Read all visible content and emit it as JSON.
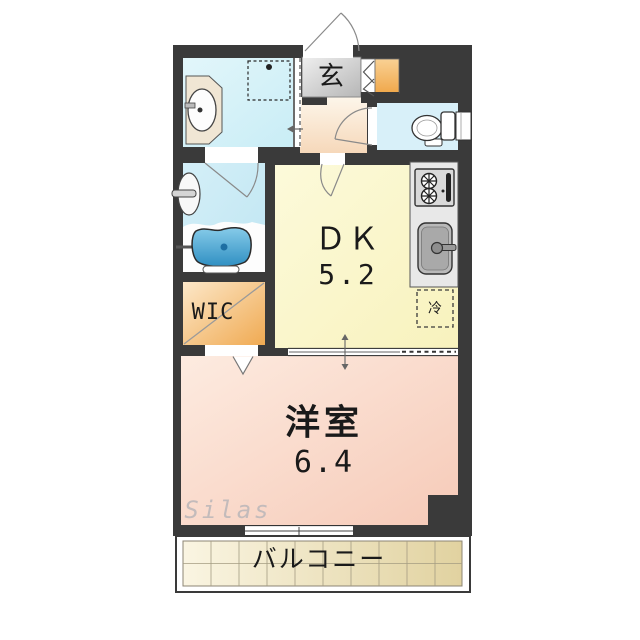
{
  "rooms": {
    "entrance": {
      "label": "玄"
    },
    "dk": {
      "label": "ＤＫ",
      "area": "5.2"
    },
    "wic": {
      "label": "WIC"
    },
    "western": {
      "label": "洋室",
      "area": "6.4"
    },
    "balcony": {
      "label": "バルコニー"
    },
    "fridge": {
      "label": "冷"
    }
  },
  "watermark": {
    "text": "Silas"
  },
  "colors": {
    "wall": "#3a3a3a",
    "dk_floor": "#fbf8d0",
    "western_floor": "#f9d6c6",
    "wic_floor": "#f5bc6e",
    "hall_floor": "#f9e2c8",
    "entrance_floor": "#d2d2d2",
    "shoe_cabinet": "#f4b75e",
    "water_rooms": "#d5eff8",
    "bathtub": "#3f9fd0",
    "balcony_tile": "#eee4bd"
  }
}
